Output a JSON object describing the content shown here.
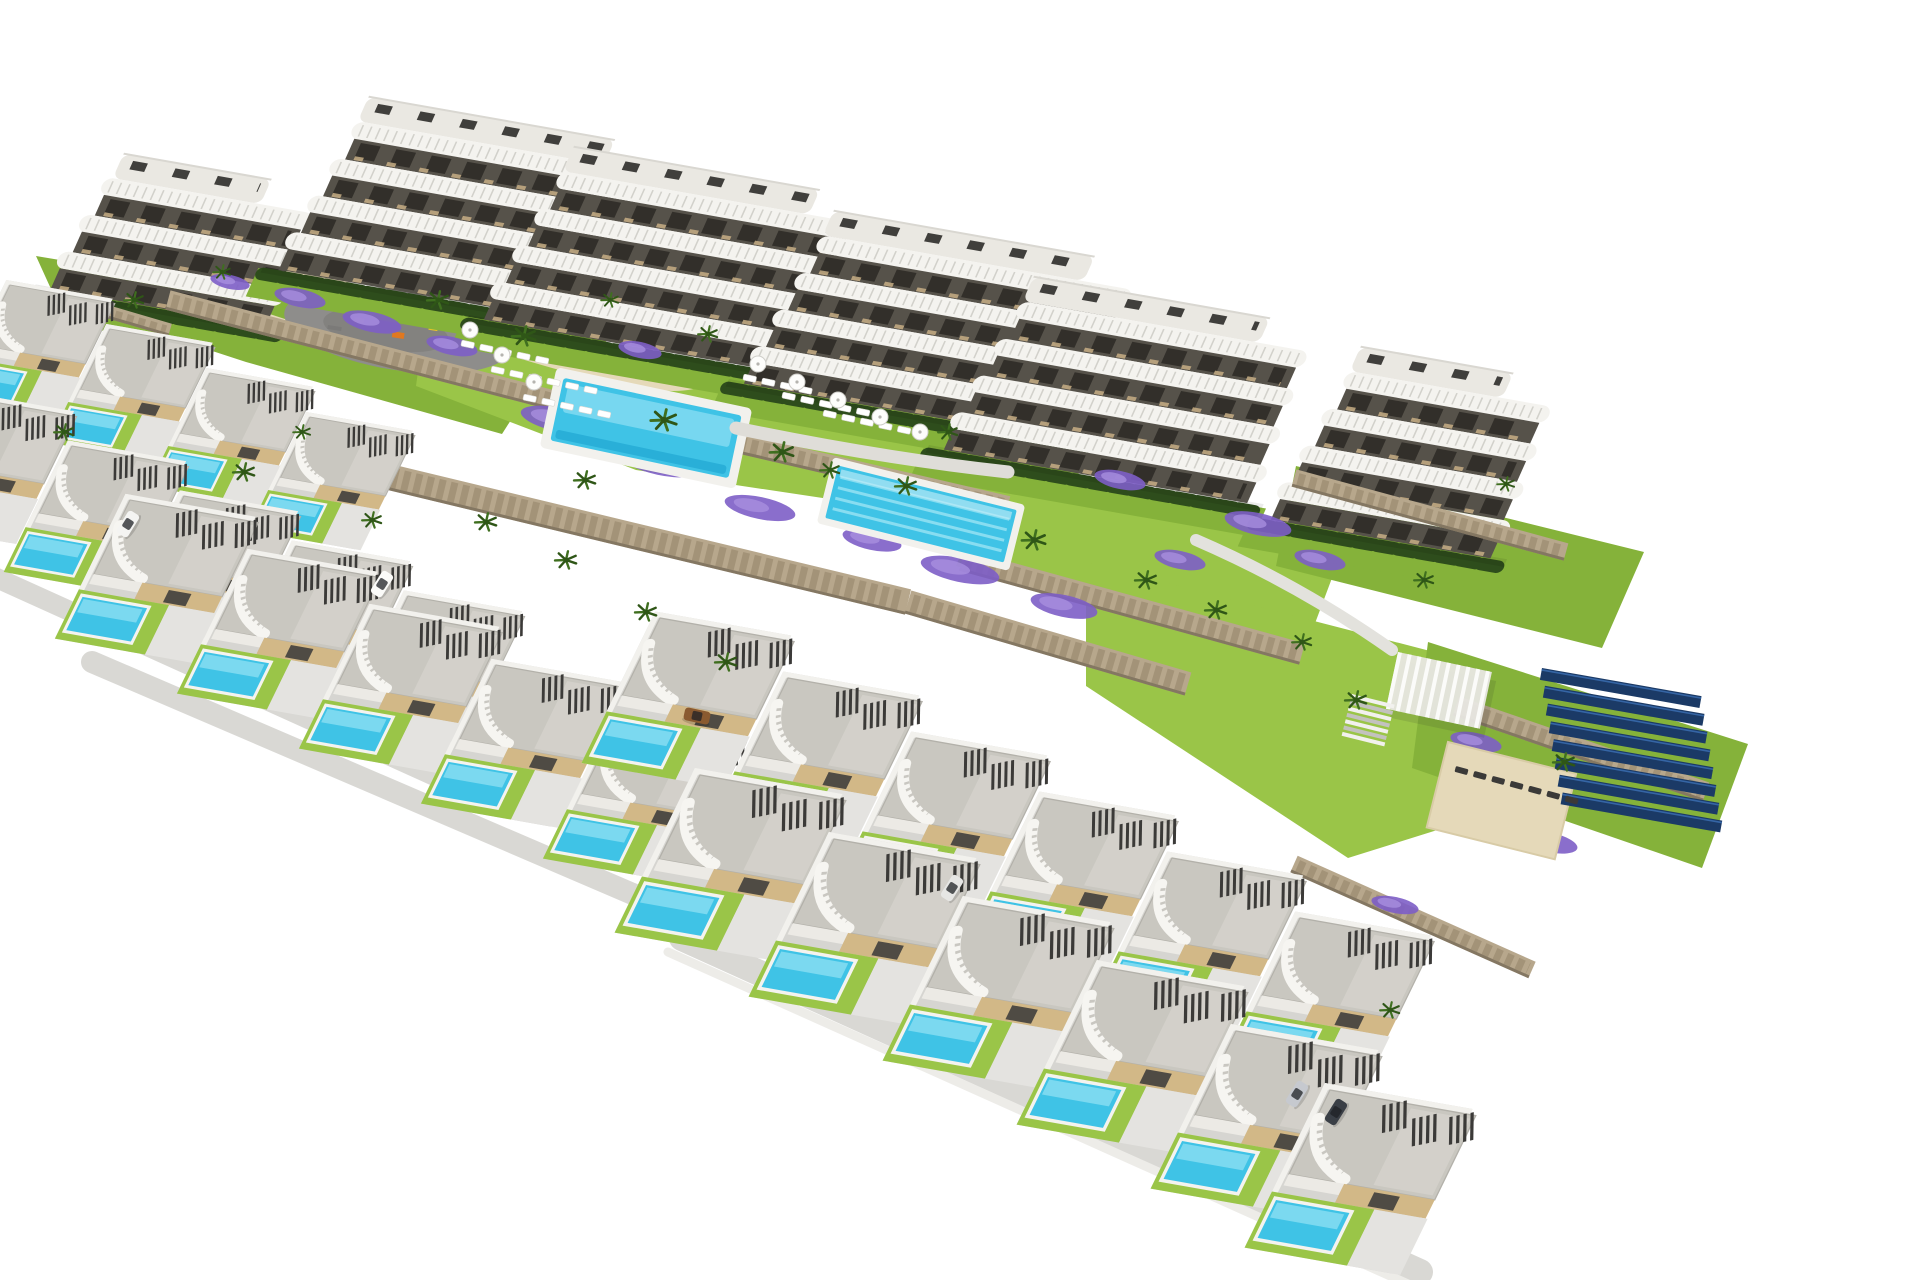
{
  "meta": {
    "type": "aerial-architectural-render",
    "description": "Aerial 3D render of a hillside residential development: six white apartment blocks with wavy balconies at the back, communal gardens with a large pool, a lap pool, playground, pergola, sun decks and a solar panel array, and staggered rows of villas with private turquoise pools in front, on a white background",
    "image_width": 1920,
    "image_height": 1280
  },
  "palette": {
    "bg": "#ffffff",
    "buildingWhite": "#f4f3ef",
    "bandTick": "#cfcec8",
    "darkStrip": "#56524a",
    "opening": "#322f2a",
    "terraceTan": "#c7ae85",
    "roofTop": "#eae8e2",
    "roofBox": "#403f3c",
    "hedge": "#2e4d1c",
    "lawn": "#85b23a",
    "lawnBright": "#9ac548",
    "sand": "#e5d9b9",
    "stone": "#b7a78c",
    "stoneDark": "#8d7d62",
    "stoneShadow": "#6e6250",
    "purple": "#7d5ec6",
    "purpleLight": "#a78fdf",
    "poolBlue": "#3fc3e6",
    "poolLight": "#90e0f3",
    "poolDeep": "#1ba2cf",
    "deckWhite": "#f2f1ed",
    "villaRoof": "#c9c7c0",
    "villaRoofLight": "#d8d6cf",
    "slatDark": "#3b3a38",
    "beige": "#d2b887",
    "pave": "#d6d5d1",
    "paveLight": "#e4e3e0",
    "road": "#d9d8d4",
    "asphalt": "#8e8d8b",
    "palm": "#3f6f1f",
    "palmDark": "#2f5617",
    "solarDark": "#1b3a66",
    "solarLight": "#3a6db0",
    "white": "#ffffff"
  },
  "scene": {
    "lawns": [
      {
        "pts": "36,256 336,306 548,362 502,434 246,362 56,300",
        "bright": false
      },
      {
        "pts": "426,312 1064,436 1022,528 636,470 416,386",
        "bright": true
      },
      {
        "pts": "996,468 1344,546 1302,658 956,566",
        "bright": true
      },
      {
        "pts": "1086,562 1434,652 1514,806 1348,858 1086,686",
        "bright": true
      },
      {
        "pts": "1296,466 1644,552 1602,648 1276,566",
        "bright": false
      },
      {
        "pts": "1428,642 1748,744 1702,868 1412,768",
        "bright": false
      }
    ],
    "sand_paths": [
      {
        "d": "M235,262 Q370,300 520,346 T700,374",
        "w": 24
      },
      {
        "d": "M205,298 Q258,318 318,336",
        "w": 13
      }
    ],
    "playground": {
      "x": 398,
      "y": 330,
      "rot": 9,
      "rx": 115,
      "ry": 40,
      "items": [
        [
          -45,
          -6,
          10,
          5,
          "#e8c32a"
        ],
        [
          -5,
          2,
          12,
          6,
          "#e07820"
        ],
        [
          30,
          -10,
          9,
          5,
          "#e8c32a"
        ],
        [
          55,
          4,
          14,
          4,
          "#7b7a78"
        ],
        [
          -70,
          6,
          14,
          4,
          "#7b7a78"
        ]
      ]
    },
    "buildings": [
      {
        "x": 95,
        "y": 175,
        "w": 230,
        "floors": 3
      },
      {
        "x": 340,
        "y": 118,
        "w": 330,
        "floors": 4
      },
      {
        "x": 545,
        "y": 168,
        "w": 330,
        "floors": 4
      },
      {
        "x": 805,
        "y": 232,
        "w": 345,
        "floors": 4
      },
      {
        "x": 1005,
        "y": 298,
        "w": 320,
        "floors": 4
      },
      {
        "x": 1332,
        "y": 368,
        "w": 235,
        "floors": 4
      }
    ],
    "walls": [
      [
        168,
        300,
        560,
        402,
        20
      ],
      [
        560,
        402,
        1008,
        506,
        20
      ],
      [
        352,
        468,
        908,
        602,
        26
      ],
      [
        908,
        602,
        1188,
        684,
        24
      ],
      [
        962,
        560,
        1302,
        654,
        22
      ],
      [
        1294,
        478,
        1566,
        552,
        18
      ],
      [
        1456,
        706,
        1706,
        792,
        20
      ],
      [
        1294,
        864,
        1532,
        970,
        18
      ],
      [
        54,
        296,
        170,
        330,
        13
      ]
    ],
    "flowers": [
      [
        300,
        298,
        26,
        9
      ],
      [
        372,
        322,
        30,
        10
      ],
      [
        452,
        346,
        26,
        9
      ],
      [
        560,
        420,
        40,
        12
      ],
      [
        660,
        462,
        42,
        13
      ],
      [
        760,
        508,
        36,
        11
      ],
      [
        872,
        540,
        30,
        10
      ],
      [
        960,
        570,
        40,
        12
      ],
      [
        1064,
        606,
        34,
        11
      ],
      [
        1180,
        560,
        26,
        9
      ],
      [
        1258,
        524,
        34,
        11
      ],
      [
        1320,
        560,
        26,
        9
      ],
      [
        1476,
        742,
        26,
        9
      ],
      [
        1548,
        842,
        30,
        10
      ],
      [
        640,
        350,
        22,
        8
      ],
      [
        1120,
        480,
        26,
        9
      ],
      [
        1395,
        905,
        24,
        8
      ],
      [
        230,
        282,
        20,
        7
      ]
    ],
    "pools": {
      "main": {
        "x": 646,
        "y": 428,
        "w": 182,
        "h": 64,
        "rot": 12
      },
      "lap": {
        "x": 921,
        "y": 514,
        "w": 184,
        "h": 54,
        "rot": 14,
        "lanes": 4
      }
    },
    "pergola": {
      "x": 1398,
      "y": 652,
      "rot": 12,
      "w": 96,
      "h": 58
    },
    "stairs": {
      "x": 1352,
      "y": 694,
      "rot": 14,
      "n": 7,
      "w": 44
    },
    "sun_deck": {
      "x": 1448,
      "y": 742,
      "rot": 14,
      "w": 132,
      "h": 88
    },
    "solar_array": {
      "x": 1542,
      "y": 668,
      "rot": 10,
      "rows": 8,
      "w": 162,
      "h": 12,
      "gap": 17,
      "shear": 6
    },
    "lounger_rows": [
      {
        "x": 462,
        "y": 340,
        "n": 5,
        "rot": 12,
        "dark": false
      },
      {
        "x": 492,
        "y": 366,
        "n": 6,
        "rot": 12,
        "dark": false
      },
      {
        "x": 524,
        "y": 394,
        "n": 5,
        "rot": 12,
        "dark": false
      },
      {
        "x": 744,
        "y": 374,
        "n": 4,
        "rot": 12,
        "dark": false
      },
      {
        "x": 783,
        "y": 392,
        "n": 5,
        "rot": 12,
        "dark": false
      },
      {
        "x": 824,
        "y": 410,
        "n": 5,
        "rot": 12,
        "dark": false
      },
      {
        "x": 1456,
        "y": 766,
        "n": 7,
        "rot": 15,
        "dark": true
      }
    ],
    "parasols": [
      [
        470,
        330
      ],
      [
        502,
        355
      ],
      [
        534,
        382
      ],
      [
        758,
        364
      ],
      [
        797,
        382
      ],
      [
        838,
        400
      ],
      [
        880,
        417
      ],
      [
        920,
        432
      ]
    ],
    "roads": [
      {
        "d": "M-52,556 L470,792",
        "w": 20
      },
      {
        "d": "M92,662 L642,898",
        "w": 22
      },
      {
        "d": "M632,780 L1292,1088",
        "w": 24
      },
      {
        "d": "M682,938 L1420,1272",
        "w": 26
      },
      {
        "d": "M668,952 L1408,1284",
        "w": 9,
        "c": "#edece8"
      },
      {
        "d": "M736,428 Q880,458 1008,472",
        "w": 13,
        "c": "#dfddd8"
      },
      {
        "d": "M1196,540 Q1300,585 1392,650",
        "w": 12,
        "c": "#e3e2dd"
      }
    ],
    "villa_rows": [
      {
        "x": 10,
        "y": 285,
        "n": 4,
        "dx": 100,
        "dy": 44,
        "s": 0.72
      },
      {
        "x": -40,
        "y": 396,
        "n": 5,
        "dx": 112,
        "dy": 50,
        "s": 0.8
      },
      {
        "x": 130,
        "y": 500,
        "n": 5,
        "dx": 122,
        "dy": 55,
        "s": 0.88
      },
      {
        "x": 660,
        "y": 618,
        "n": 6,
        "dx": 128,
        "dy": 60,
        "s": 0.92
      },
      {
        "x": 700,
        "y": 775,
        "n": 5,
        "dx": 134,
        "dy": 64,
        "s": 1.0
      },
      {
        "x": 1330,
        "y": 1090,
        "n": 1,
        "dx": 0,
        "dy": 0,
        "s": 1.0
      }
    ],
    "palms": [
      [
        438,
        300,
        1
      ],
      [
        524,
        336,
        1.1
      ],
      [
        610,
        300,
        0.8
      ],
      [
        664,
        420,
        1.2
      ],
      [
        708,
        334,
        0.9
      ],
      [
        782,
        452,
        1.1
      ],
      [
        906,
        486,
        1
      ],
      [
        948,
        432,
        0.9
      ],
      [
        1034,
        540,
        1.1
      ],
      [
        1146,
        580,
        1
      ],
      [
        1216,
        610,
        1
      ],
      [
        1302,
        642,
        0.9
      ],
      [
        486,
        522,
        1
      ],
      [
        566,
        560,
        1
      ],
      [
        646,
        612,
        1
      ],
      [
        726,
        662,
        1
      ],
      [
        1356,
        700,
        1
      ],
      [
        1424,
        580,
        0.9
      ],
      [
        1506,
        484,
        0.8
      ],
      [
        1564,
        762,
        1
      ],
      [
        134,
        300,
        0.9
      ],
      [
        222,
        272,
        0.8
      ],
      [
        64,
        432,
        0.9
      ],
      [
        244,
        472,
        1
      ],
      [
        372,
        520,
        0.9
      ],
      [
        302,
        432,
        0.8
      ],
      [
        1390,
        1010,
        0.9
      ],
      [
        830,
        470,
        0.9
      ],
      [
        585,
        480,
        1
      ]
    ],
    "vehicles": [
      {
        "x": 128,
        "y": 524,
        "rot": -58,
        "c": "#f4f4f2"
      },
      {
        "x": 382,
        "y": 584,
        "rot": -58,
        "c": "#fbfbf9"
      },
      {
        "x": 697,
        "y": 716,
        "rot": 12,
        "c": "#8a5a30"
      },
      {
        "x": 952,
        "y": 888,
        "rot": -58,
        "c": "#e6e6e4"
      },
      {
        "x": 1297,
        "y": 1094,
        "rot": -58,
        "c": "#c6c9cf"
      },
      {
        "x": 1336,
        "y": 1112,
        "rot": -58,
        "c": "#3a3f46"
      }
    ]
  }
}
